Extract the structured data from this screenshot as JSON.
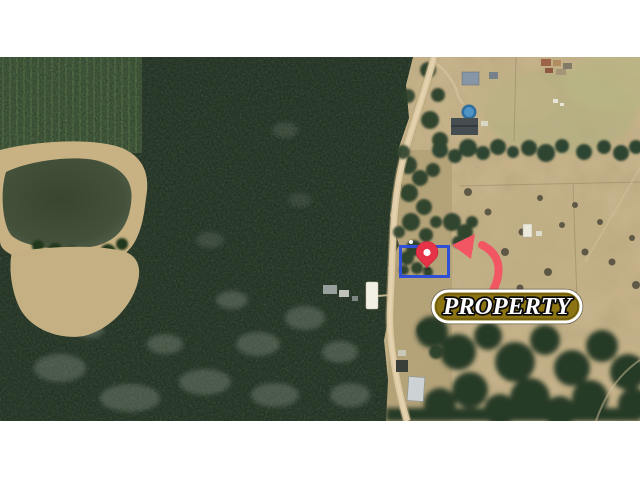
{
  "map": {
    "badge": {
      "label": "PROPERTY"
    },
    "icons": {
      "pin": "location-pin-icon",
      "arrow": "curved-arrow-icon",
      "boundary": "property-boundary-rectangle"
    },
    "colors": {
      "boundary_blue": "#2e4fd6",
      "pin_red": "#e73347",
      "pin_dot": "#ffffff",
      "arrow_red": "#f25663",
      "badge_fill": "#8c7412",
      "badge_border": "#ffffff",
      "badge_text": "#ffffff",
      "badge_outline": "#0d0d0d"
    }
  }
}
